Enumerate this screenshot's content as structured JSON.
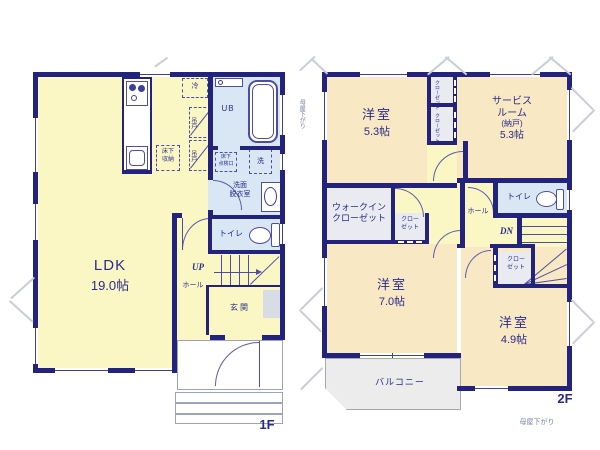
{
  "colors": {
    "wall": "#23237d",
    "room_yellow": "#fbf7c5",
    "room_peach": "#f8e8c4",
    "wet_blue": "#d9e6f4",
    "closet_gray": "#e9ebf1",
    "text": "#2b2b8a"
  },
  "floor1": {
    "floor_label": "1F",
    "rooms": {
      "ldk": {
        "name": "LDK",
        "size": "19.0帖"
      },
      "bath": "UB",
      "washroom_l1": "洗面",
      "washroom_l2": "脱衣室",
      "toilet": "トイレ",
      "hall": "ホール",
      "entrance": "玄関"
    },
    "fixtures": {
      "fridge": "冷",
      "hanging_cupboard": "吊戸",
      "floor_storage_l1": "床下",
      "floor_storage_l2": "収納",
      "hatch_l1": "床下",
      "hatch_l2": "点検口",
      "washer": "洗"
    },
    "stairs": {
      "up": "UP"
    }
  },
  "floor2": {
    "floor_label": "2F",
    "notes": {
      "left": "母屋下がり",
      "bottom": "母屋下がり"
    },
    "rooms": {
      "west1": {
        "name": "洋室",
        "size": "5.3帖"
      },
      "service": {
        "l1": "サービス",
        "l2": "ルーム",
        "l3": "(納戸)",
        "l4": "5.3帖"
      },
      "west2": {
        "name": "洋室",
        "size": "7.0帖"
      },
      "west3": {
        "name": "洋室",
        "size": "4.9帖"
      },
      "toilet": "トイレ",
      "hall": "ホール",
      "balcony": "バルコニー",
      "wic_l1": "ウォークイン",
      "wic_l2": "クローゼット",
      "closet_vertical": "クローゼット",
      "closet_l1": "クロー",
      "closet_l2": "ゼット"
    },
    "stairs": {
      "down": "DN"
    }
  }
}
